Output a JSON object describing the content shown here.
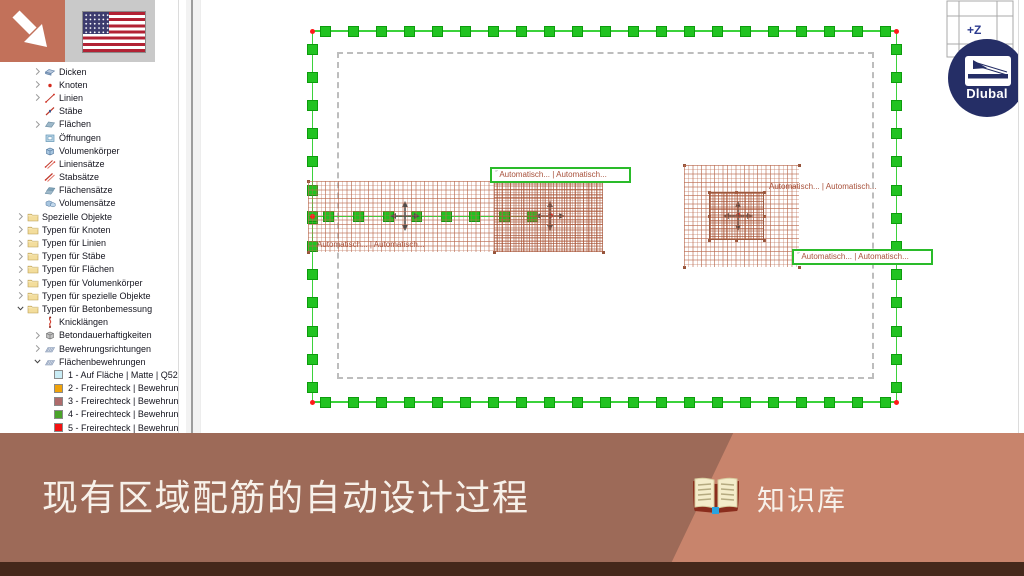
{
  "colors": {
    "accent_orange": "#c2715a",
    "banner_left": "#9d6a58",
    "banner_right": "#c8846c",
    "banner_strip": "#45281b",
    "logo_navy": "#252e66",
    "selection_green": "#21c321",
    "mesh_brown": "#ba6a4e",
    "label_text": "#a8503a"
  },
  "sidebar": {
    "items": [
      {
        "key": "dicken",
        "label": "Dicken",
        "level": 2,
        "chevron": "collapsed",
        "icon": "dicken"
      },
      {
        "key": "knoten",
        "label": "Knoten",
        "level": 2,
        "chevron": "collapsed",
        "icon": "knoten"
      },
      {
        "key": "linien",
        "label": "Linien",
        "level": 2,
        "chevron": "collapsed",
        "icon": "linien"
      },
      {
        "key": "staebe",
        "label": "Stäbe",
        "level": 2,
        "chevron": "none",
        "icon": "staebe"
      },
      {
        "key": "flaechen",
        "label": "Flächen",
        "level": 2,
        "chevron": "collapsed",
        "icon": "flaechen"
      },
      {
        "key": "oeffnungen",
        "label": "Öffnungen",
        "level": 2,
        "chevron": "none",
        "icon": "oeffnungen"
      },
      {
        "key": "volumenkoerper",
        "label": "Volumenkörper",
        "level": 2,
        "chevron": "none",
        "icon": "volumenkoerper"
      },
      {
        "key": "liniensaetze",
        "label": "Liniensätze",
        "level": 2,
        "chevron": "none",
        "icon": "liniensaetze"
      },
      {
        "key": "stabsaetze",
        "label": "Stabsätze",
        "level": 2,
        "chevron": "none",
        "icon": "stabsaetze"
      },
      {
        "key": "flaechensaetze",
        "label": "Flächensätze",
        "level": 2,
        "chevron": "none",
        "icon": "flaechensaetze"
      },
      {
        "key": "volumensaetze",
        "label": "Volumensätze",
        "level": 2,
        "chevron": "none",
        "icon": "volumensaetze"
      },
      {
        "key": "spezielle-objekte",
        "label": "Spezielle Objekte",
        "level": 1,
        "chevron": "collapsed",
        "icon": "folder"
      },
      {
        "key": "typen-fuer-knoten",
        "label": "Typen für Knoten",
        "level": 1,
        "chevron": "collapsed",
        "icon": "folder"
      },
      {
        "key": "typen-fuer-linien",
        "label": "Typen für Linien",
        "level": 1,
        "chevron": "collapsed",
        "icon": "folder"
      },
      {
        "key": "typen-fuer-staebe",
        "label": "Typen für Stäbe",
        "level": 1,
        "chevron": "collapsed",
        "icon": "folder"
      },
      {
        "key": "typen-fuer-flaechen",
        "label": "Typen für Flächen",
        "level": 1,
        "chevron": "collapsed",
        "icon": "folder"
      },
      {
        "key": "typen-fuer-volumenkoerper",
        "label": "Typen für Volumenkörper",
        "level": 1,
        "chevron": "collapsed",
        "icon": "folder"
      },
      {
        "key": "typen-fuer-spezielle-objekte",
        "label": "Typen für spezielle Objekte",
        "level": 1,
        "chevron": "collapsed",
        "icon": "folder"
      },
      {
        "key": "typen-fuer-betonbemessung",
        "label": "Typen für Betonbemessung",
        "level": 1,
        "chevron": "expanded",
        "icon": "folder"
      },
      {
        "key": "knicklaengen",
        "label": "Knicklängen",
        "level": 2,
        "chevron": "none",
        "icon": "knicklaengen"
      },
      {
        "key": "betondauerhaftigkeiten",
        "label": "Betondauerhaftigkeiten",
        "level": 2,
        "chevron": "collapsed",
        "icon": "beton"
      },
      {
        "key": "bewehrungsrichtungen",
        "label": "Bewehrungsrichtungen",
        "level": 2,
        "chevron": "collapsed",
        "icon": "bewehrung"
      },
      {
        "key": "flaechenbewehrungen",
        "label": "Flächenbewehrungen",
        "level": 2,
        "chevron": "expanded",
        "icon": "bewehrung"
      },
      {
        "key": "flaechenbewehrung-1",
        "label": "1 - Auf Fläche | Matte | Q524A",
        "level": 3,
        "chevron": "none",
        "swatch": "#c9ecf5"
      },
      {
        "key": "flaechenbewehrung-2",
        "label": "2 - Freirechteck | Bewehrungs",
        "level": 3,
        "chevron": "none",
        "swatch": "#f0a30a"
      },
      {
        "key": "flaechenbewehrung-3",
        "label": "3 - Freirechteck | Bewehrungs",
        "level": 3,
        "chevron": "none",
        "swatch": "#ae6b6b"
      },
      {
        "key": "flaechenbewehrung-4",
        "label": "4 - Freirechteck | Bewehrungs",
        "level": 3,
        "chevron": "none",
        "swatch": "#4aa32a"
      },
      {
        "key": "flaechenbewehrung-5",
        "label": "5 - Freirechteck | Bewehrungs",
        "level": 3,
        "chevron": "none",
        "swatch": "#f31111"
      }
    ]
  },
  "canvas": {
    "label_marker": "˝",
    "labels": [
      {
        "text": "Automatisch... | Automatisch...",
        "boxed": false
      },
      {
        "text": "Automatisch... | Automatisch...",
        "boxed": true
      },
      {
        "text": "Automatisch... | Automatisch...",
        "boxed": false
      },
      {
        "text": "Automatisch... | Automatisch...",
        "boxed": true
      }
    ],
    "viewcube_label": "+Z",
    "logo_text": "Dlubal"
  },
  "banner": {
    "title": "现有区域配筋的自动设计过程",
    "kb_label": "知识库"
  }
}
